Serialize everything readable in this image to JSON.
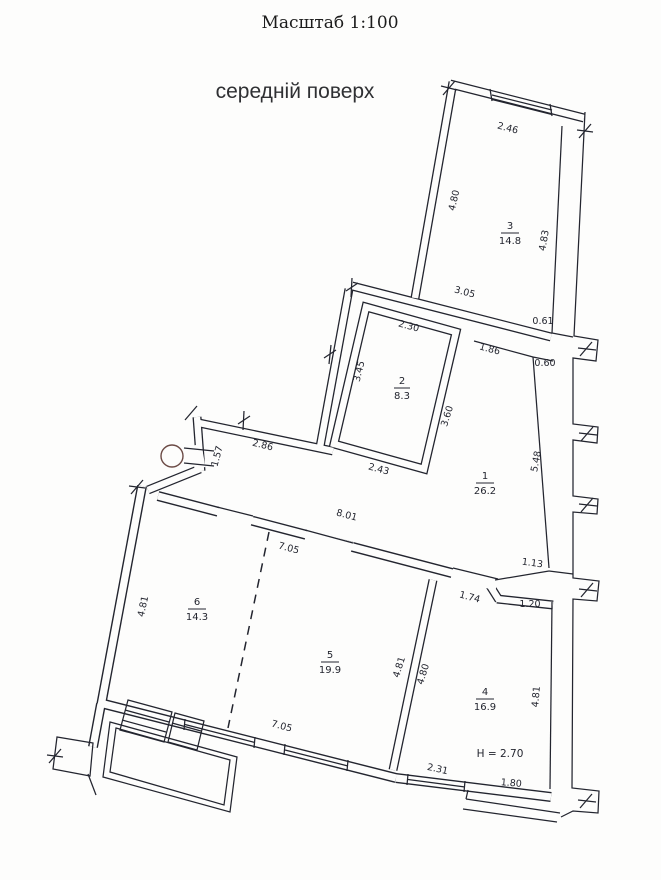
{
  "title": "Масштаб 1:100",
  "subtitle": "середній поверх",
  "height_note": "H = 2.70",
  "rooms": [
    {
      "number": "1",
      "area": "26.2"
    },
    {
      "number": "2",
      "area": "8.3"
    },
    {
      "number": "3",
      "area": "14.8"
    },
    {
      "number": "4",
      "area": "16.9"
    },
    {
      "number": "5",
      "area": "19.9"
    },
    {
      "number": "6",
      "area": "14.3"
    }
  ],
  "dims": {
    "win_246": "2.46",
    "r3_left_480": "4.80",
    "r3_right_483": "4.83",
    "wall_305": "3.05",
    "notch_061": "0.61",
    "door_186": "1.86",
    "notch_060": "0.60",
    "right_548": "5.48",
    "r2_top_230": "2.30",
    "r2_left_345": "3.45",
    "r2_right_360": "3.60",
    "r2_bot_243": "2.43",
    "hall_286": "2.86",
    "win_157": "1.57",
    "corr_801": "8.01",
    "top_705": "7.05",
    "door_174": "1.74",
    "pass_113": "1.13",
    "pass_120": "1.20",
    "r6_left_481": "4.81",
    "bot_705": "7.05",
    "w54_left_481": "4.81",
    "w54_right_480": "4.80",
    "r4_right_481": "4.81",
    "win_231": "2.31",
    "bot_180": "1.80"
  },
  "colors": {
    "ink": "#23252f",
    "paper": "#fdfdfc",
    "circle": "#6b4a45"
  }
}
